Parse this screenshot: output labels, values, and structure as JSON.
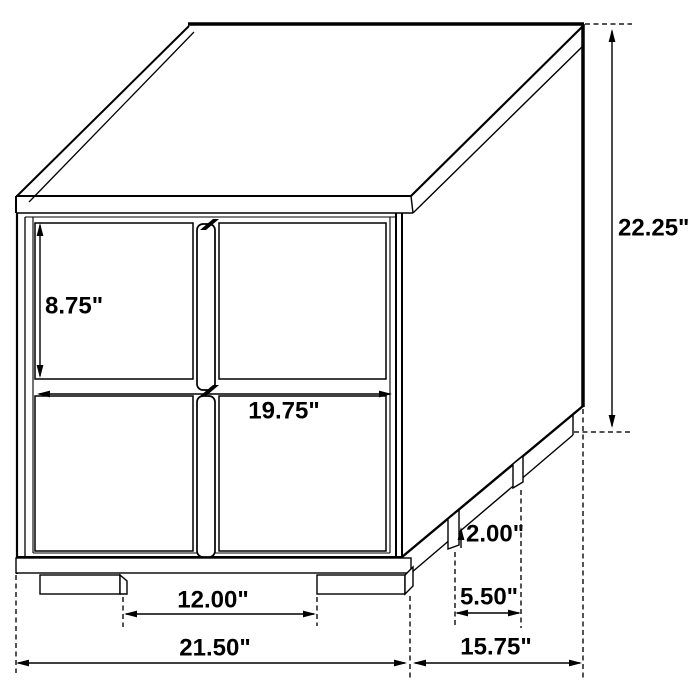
{
  "title": "Two-drawer nightstand dimension diagram",
  "colors": {
    "background": "#ffffff",
    "line": "#000000",
    "text": "#000000"
  },
  "dimensions": {
    "overall_height": {
      "label": "22.25\""
    },
    "drawer_height": {
      "label": "8.75\""
    },
    "drawer_width": {
      "label": "19.75\""
    },
    "foot_height": {
      "label": "2.00\""
    },
    "side_foot_spacing": {
      "label": "5.50\""
    },
    "front_foot_spacing": {
      "label": "12.00\""
    },
    "overall_width": {
      "label": "21.50\""
    },
    "overall_depth": {
      "label": "15.75\""
    }
  }
}
